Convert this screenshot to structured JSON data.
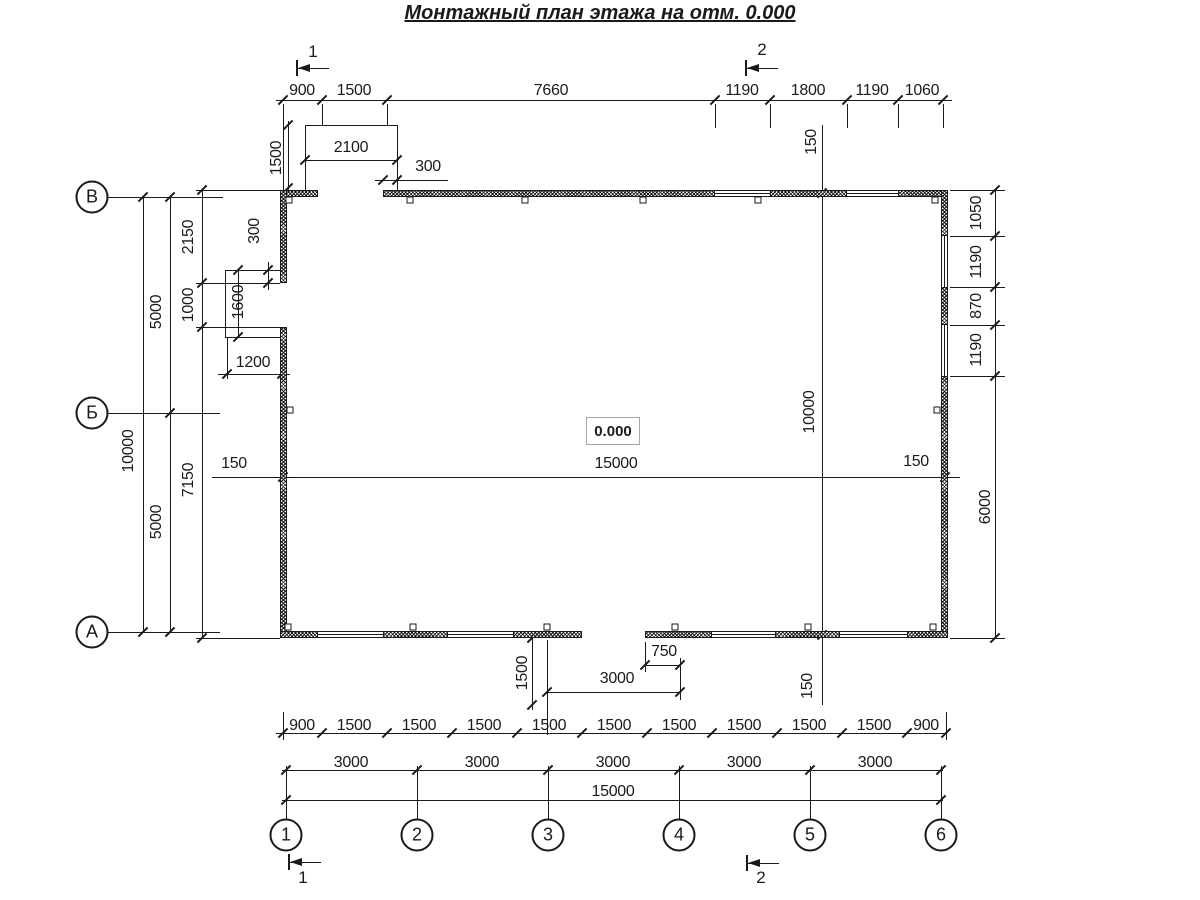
{
  "title": "Монтажный план этажа на отм. 0.000",
  "elevation_mark": "0.000",
  "axes_bottom": [
    {
      "label": "1"
    },
    {
      "label": "2"
    },
    {
      "label": "3"
    },
    {
      "label": "4"
    },
    {
      "label": "5"
    },
    {
      "label": "6"
    }
  ],
  "axes_left": [
    {
      "label": "В"
    },
    {
      "label": "Б"
    },
    {
      "label": "А"
    }
  ],
  "section_marks": [
    {
      "label": "1"
    },
    {
      "label": "2"
    },
    {
      "label": "1"
    },
    {
      "label": "2"
    }
  ],
  "dimensions": {
    "top_chain": [
      "900",
      "1500",
      "7660",
      "1190",
      "1800",
      "1190",
      "1060"
    ],
    "bottom_chain_detail": [
      "900",
      "1500",
      "1500",
      "1500",
      "1500",
      "1500",
      "1500",
      "1500",
      "1500",
      "1500",
      "900"
    ],
    "bottom_chain_axes": [
      "3000",
      "3000",
      "3000",
      "3000",
      "3000"
    ],
    "bottom_total": [
      "15000"
    ],
    "left_chain": [
      "2150",
      "1000",
      "7150"
    ],
    "left_axes": [
      "5000",
      "5000"
    ],
    "left_total": [
      "10000"
    ],
    "right_chain": [
      "1050",
      "1190",
      "870",
      "1190",
      "6000"
    ],
    "interior_width": [
      "150",
      "15000",
      "150"
    ],
    "interior_height": [
      "150",
      "10000",
      "150"
    ],
    "top_porch": [
      "1500",
      "2100",
      "300"
    ],
    "left_porch": [
      "300",
      "1600",
      "1200"
    ],
    "bottom_porch": [
      "1500",
      "3000",
      "750"
    ]
  }
}
